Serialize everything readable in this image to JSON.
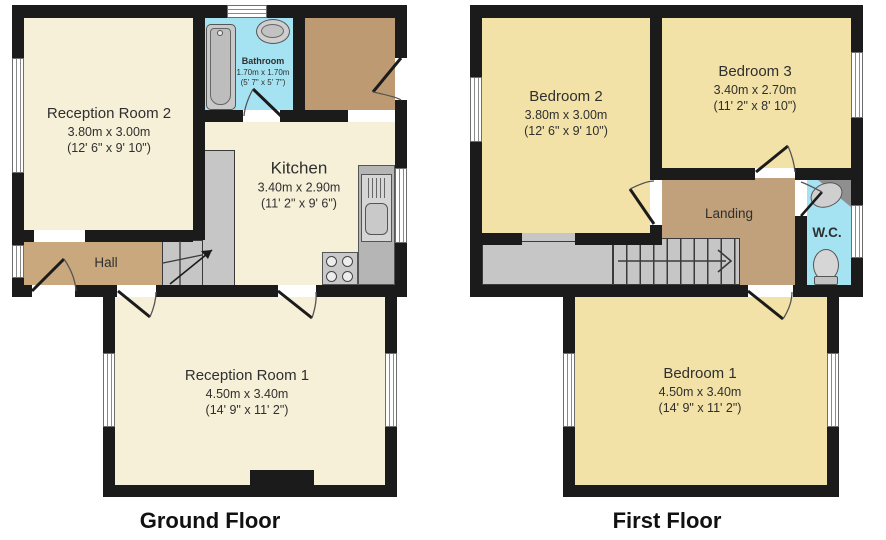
{
  "ground": {
    "title": "Ground Floor",
    "rooms": {
      "reception2": {
        "name": "Reception Room 2",
        "metric": "3.80m x 3.00m",
        "imperial": "(12' 6\" x 9' 10\")"
      },
      "bathroom": {
        "name": "Bathroom",
        "metric": "1.70m x 1.70m",
        "imperial": "(5' 7\" x 5' 7\")"
      },
      "kitchen": {
        "name": "Kitchen",
        "metric": "3.40m x 2.90m",
        "imperial": "(11' 2\" x 9' 6\")"
      },
      "hall": {
        "name": "Hall"
      },
      "reception1": {
        "name": "Reception Room 1",
        "metric": "4.50m x 3.40m",
        "imperial": "(14' 9\" x 11' 2\")"
      }
    }
  },
  "first": {
    "title": "First Floor",
    "rooms": {
      "bedroom2": {
        "name": "Bedroom 2",
        "metric": "3.80m x 3.00m",
        "imperial": "(12' 6\" x 9' 10\")"
      },
      "bedroom3": {
        "name": "Bedroom 3",
        "metric": "3.40m x 2.70m",
        "imperial": "(11' 2\" x 8' 10\")"
      },
      "landing": {
        "name": "Landing"
      },
      "wc": {
        "name": "W.C."
      },
      "bedroom1": {
        "name": "Bedroom 1",
        "metric": "4.50m x 3.40m",
        "imperial": "(14' 9\" x 11' 2\")"
      }
    }
  },
  "colors": {
    "wall": "#1b1b1b",
    "reception_cream": "#f7f0d8",
    "bedroom_yellow": "#f3e2a7",
    "hall_brown": "#c9a87e",
    "entrance_brown": "#bd9a72",
    "landing_brown": "#c1a17b",
    "wet_room_cyan": "#a6e3f2",
    "stair_gray": "#c6c6c6"
  }
}
